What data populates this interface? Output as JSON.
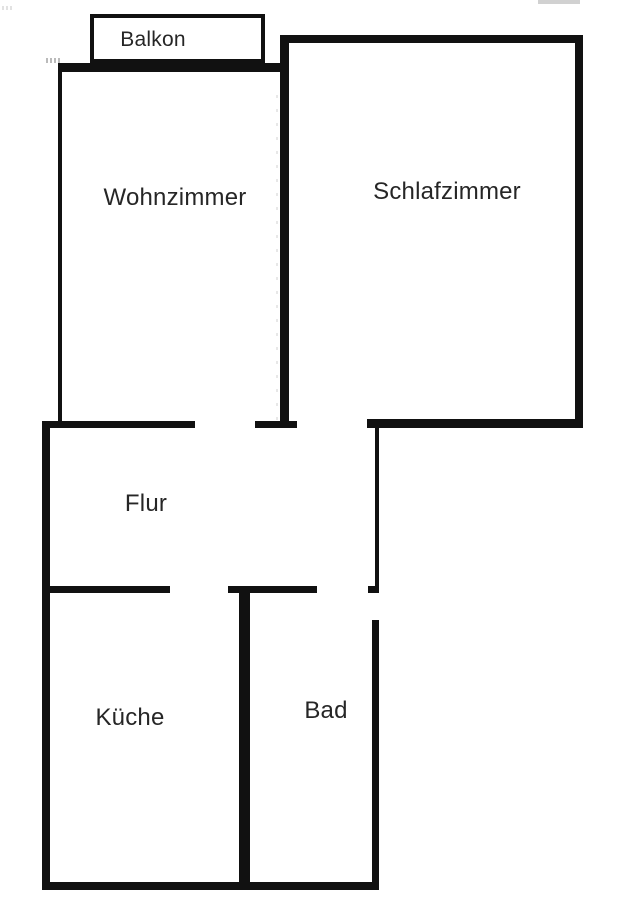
{
  "plan": {
    "type": "floor-plan",
    "rooms": [
      {
        "id": "balkon",
        "label": "Balkon"
      },
      {
        "id": "wohnzimmer",
        "label": "Wohnzimmer"
      },
      {
        "id": "schlafzimmer",
        "label": "Schlafzimmer"
      },
      {
        "id": "flur",
        "label": "Flur"
      },
      {
        "id": "kueche",
        "label": "Küche"
      },
      {
        "id": "bad",
        "label": "Bad"
      }
    ],
    "colors": {
      "wall": "#111111",
      "background": "#ffffff",
      "text": "#262626"
    }
  }
}
